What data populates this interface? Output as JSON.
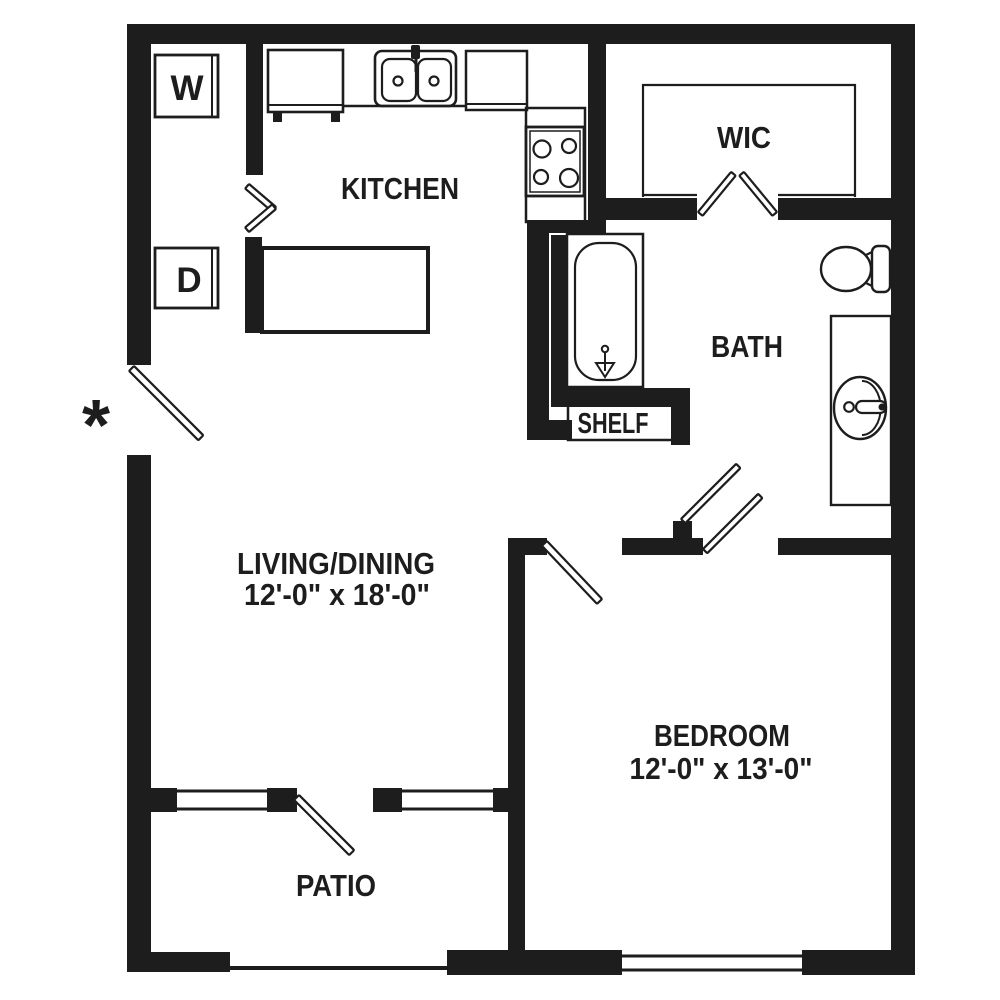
{
  "floorplan": {
    "rooms": {
      "kitchen": {
        "label": "KITCHEN"
      },
      "wic": {
        "label": "WIC"
      },
      "bath": {
        "label": "BATH"
      },
      "shelf": {
        "label": "SHELF"
      },
      "living_dining": {
        "label": "LIVING/DINING",
        "dimensions": "12'-0\" x 18'-0\""
      },
      "bedroom": {
        "label": "BEDROOM",
        "dimensions": "12'-0\" x 13'-0\""
      },
      "patio": {
        "label": "PATIO"
      }
    },
    "appliances": {
      "washer": "W",
      "dryer": "D"
    },
    "entry_marker": "*",
    "colors": {
      "ink": "#1d1d1d",
      "background": "#ffffff"
    }
  }
}
